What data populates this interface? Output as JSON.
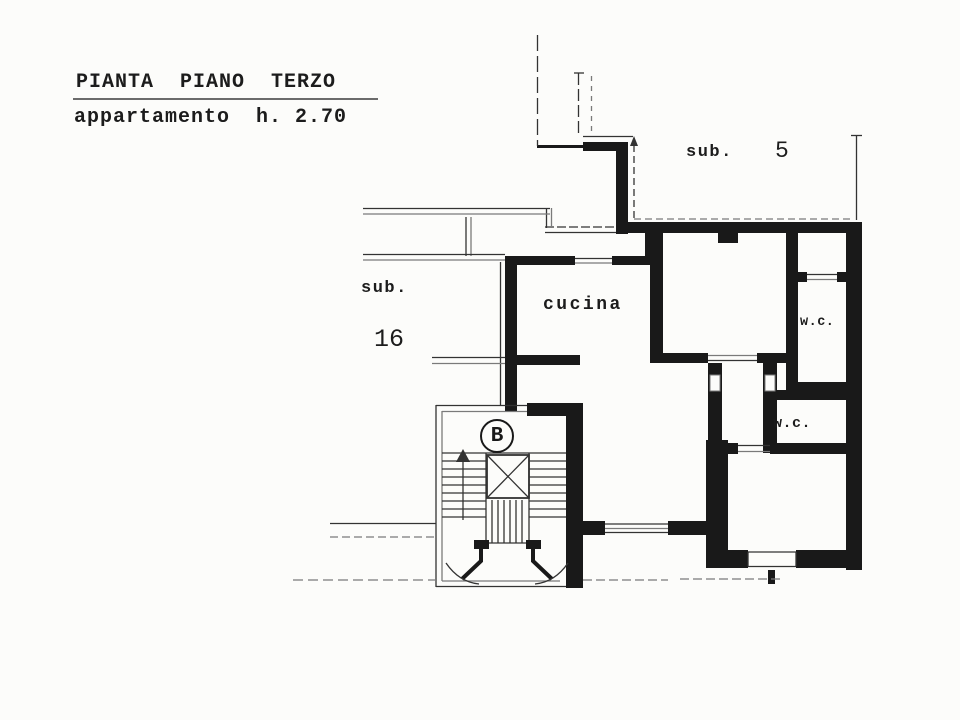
{
  "header": {
    "title": "PIANTA  PIANO  TERZO",
    "subtitle": "appartamento  h. 2.70"
  },
  "labels": {
    "sub5_prefix": "sub.",
    "sub5_number": "5",
    "sub16_prefix": "sub.",
    "sub16_number": "16",
    "kitchen": "cucina",
    "wc_upper": "w.c.",
    "wc_lower": "w.c.",
    "stair_letter": "B"
  },
  "colors": {
    "paper": "#fcfcfa",
    "ink": "#191919",
    "thin": "#333333",
    "faint": "#7a7a7a"
  }
}
